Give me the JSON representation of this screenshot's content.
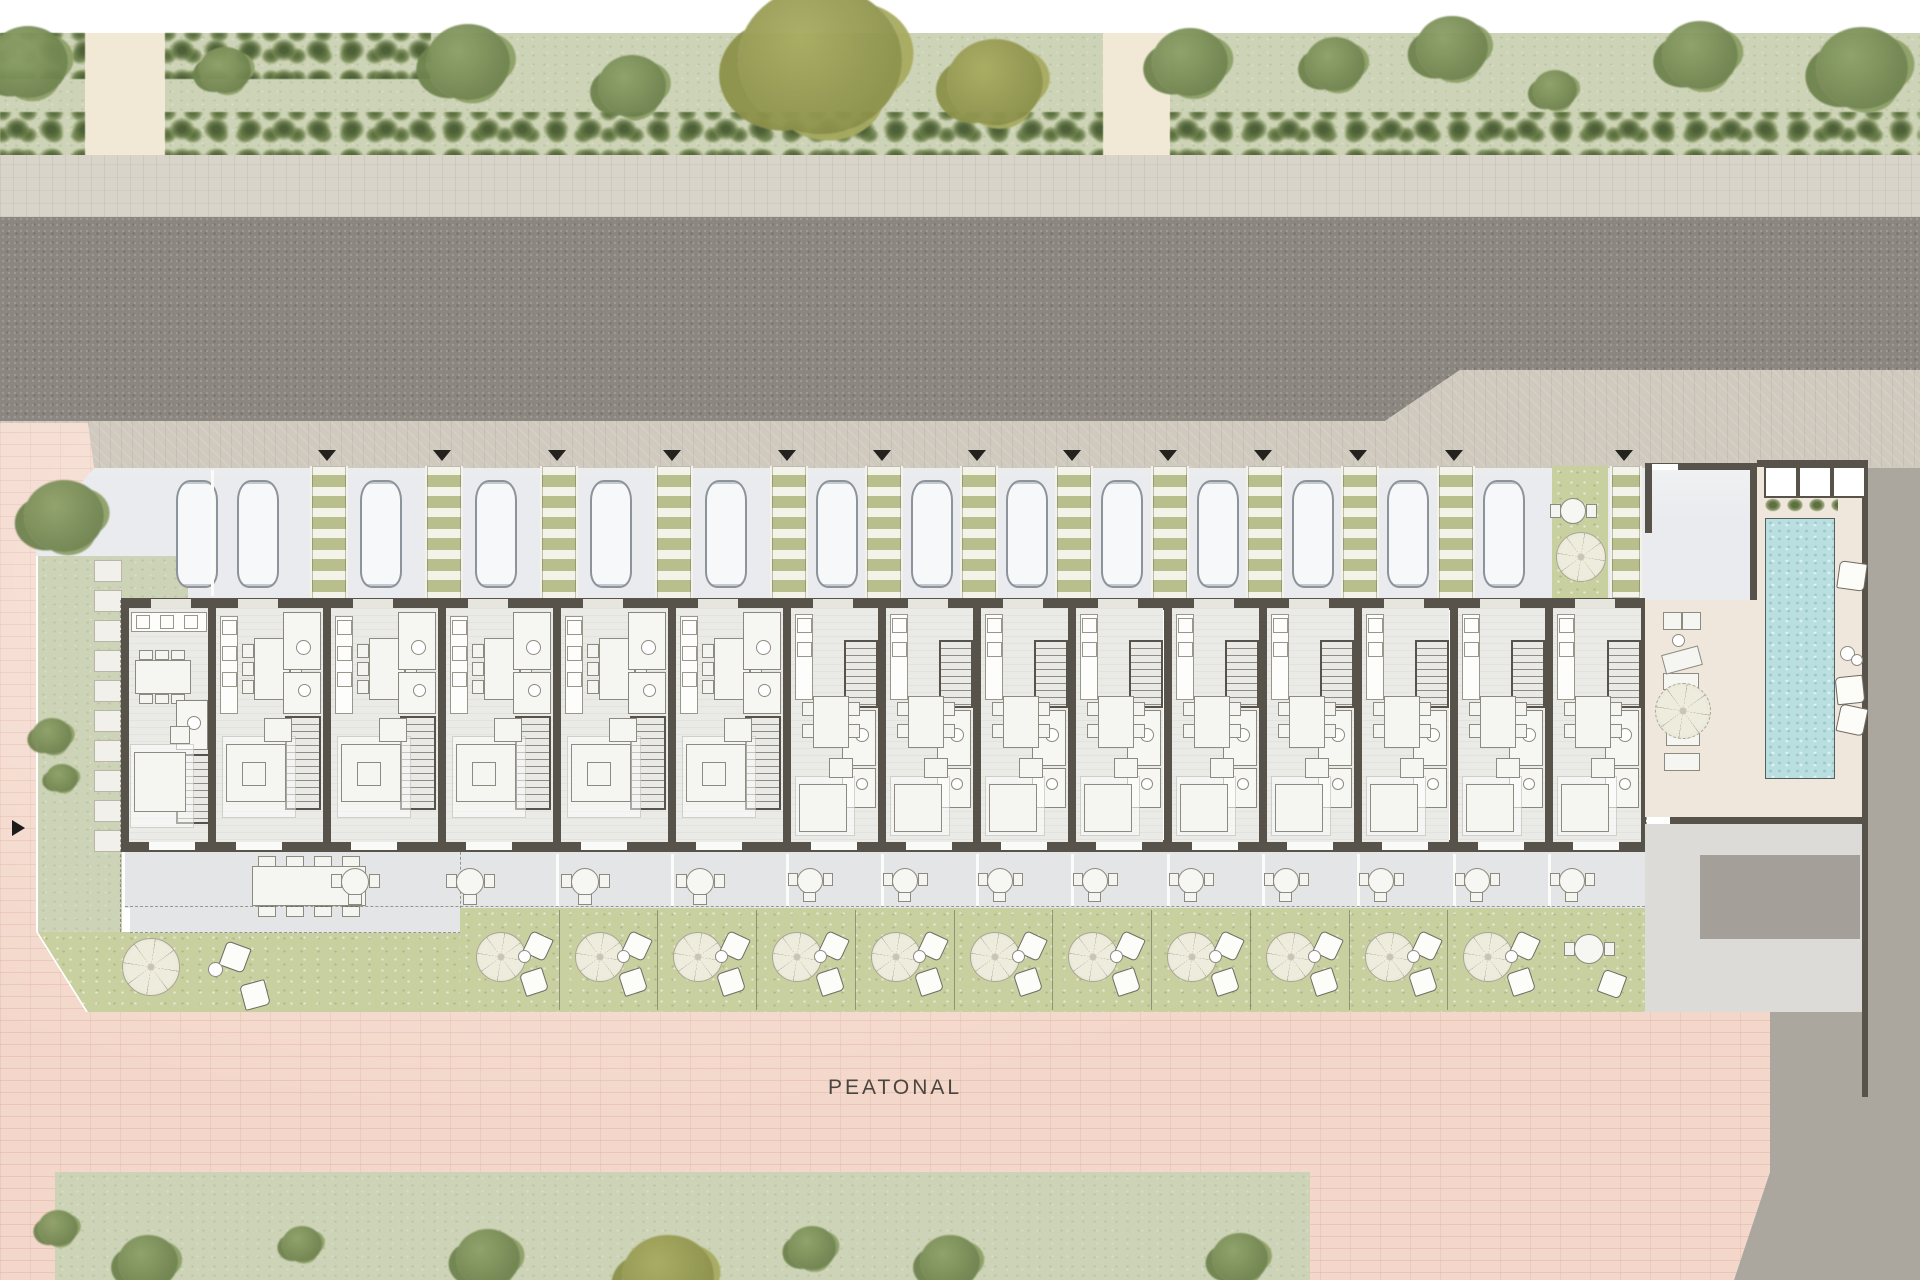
{
  "page": {
    "peatonal_label": "PEATONAL"
  },
  "palette": {
    "white_strip": "#ffffff",
    "lawn": "#cdd3b6",
    "road": "#8b8680",
    "sidewalk": "#d9d4c9",
    "sidewalk2": "#cfc9be",
    "plaza": "#f3d7ca",
    "parking": "#e9ebee",
    "walkway_olive": "#b8be8c",
    "walkway_rung": "#f3f3ea",
    "wall": "#57534a",
    "floor": "#eaeae6",
    "terrace": "#e4e5e7",
    "garden": "#c9d0a0",
    "pool": "#b9dfe0",
    "deck": "#efe7dc",
    "gray_light": "#dcdbd8",
    "gray_out": "#aba69e",
    "gray_mid": "#a49f98",
    "car_fill": "#f7f8fa",
    "car_line": "#8d939b",
    "furn_line": "#8d8a80",
    "furn_fill": "#f5f5f1",
    "text": "#4a463f",
    "beige": "#f1e9d6",
    "tri": "#23221f",
    "tree_green_1": "#8ea168",
    "tree_green_2": "#6f834e",
    "tree_olive_1": "#a8ab60",
    "tree_olive_2": "#8c914a"
  },
  "geo": {
    "white_top": [
      0,
      0,
      1920,
      33
    ],
    "verge_top": [
      0,
      33,
      1920,
      127
    ],
    "sidewalk1": [
      0,
      155,
      1920,
      62
    ],
    "road_poly": [
      [
        0,
        217
      ],
      [
        1920,
        217
      ],
      [
        1920,
        370
      ],
      [
        1460,
        370
      ],
      [
        1385,
        421
      ],
      [
        0,
        421
      ]
    ],
    "walk2_poly": [
      [
        0,
        421
      ],
      [
        1385,
        421
      ],
      [
        1460,
        370
      ],
      [
        1920,
        370
      ],
      [
        1920,
        468
      ],
      [
        0,
        472
      ]
    ],
    "plaza_poly": [
      [
        0,
        423
      ],
      [
        88,
        423
      ],
      [
        94,
        468
      ],
      [
        36,
        538
      ],
      [
        36,
        932
      ],
      [
        86,
        1012
      ],
      [
        1770,
        1012
      ],
      [
        1770,
        1172
      ],
      [
        1734,
        1280
      ],
      [
        0,
        1280
      ]
    ],
    "parking_poly": [
      [
        94,
        468
      ],
      [
        1645,
        468
      ],
      [
        1645,
        600
      ],
      [
        188,
        600
      ],
      [
        188,
        556
      ],
      [
        36,
        556
      ],
      [
        36,
        538
      ]
    ],
    "verge_bottom": [
      55,
      1172,
      1255,
      108
    ],
    "beige_paths": [
      [
        85,
        33,
        80,
        127
      ],
      [
        1103,
        33,
        67,
        127
      ],
      [
        345,
        1186,
        82,
        94
      ]
    ],
    "hedges": [
      [
        0,
        33,
        85,
        46
      ],
      [
        165,
        33,
        266,
        46
      ],
      [
        0,
        112,
        85,
        48
      ],
      [
        165,
        112,
        938,
        48
      ],
      [
        1170,
        112,
        750,
        48
      ],
      [
        60,
        1172,
        285,
        42
      ],
      [
        427,
        1172,
        885,
        42
      ],
      [
        55,
        1172,
        48,
        108
      ]
    ],
    "trees_top": [
      [
        28,
        62,
        40,
        "g"
      ],
      [
        225,
        70,
        26,
        "g"
      ],
      [
        468,
        62,
        42,
        "g"
      ],
      [
        632,
        86,
        34,
        "g"
      ],
      [
        820,
        60,
        82,
        "o"
      ],
      [
        995,
        82,
        48,
        "o"
      ],
      [
        1190,
        62,
        38,
        "g"
      ],
      [
        1335,
        64,
        30,
        "g"
      ],
      [
        1452,
        48,
        36,
        "g"
      ],
      [
        1555,
        90,
        22,
        "g"
      ],
      [
        1700,
        55,
        38,
        "g"
      ],
      [
        1862,
        68,
        46,
        "g"
      ]
    ],
    "trees_bottom": [
      [
        58,
        1228,
        20,
        "g"
      ],
      [
        148,
        1262,
        30,
        "g"
      ],
      [
        302,
        1244,
        20,
        "g"
      ],
      [
        488,
        1258,
        32,
        "g"
      ],
      [
        668,
        1276,
        46,
        "o"
      ],
      [
        812,
        1248,
        24,
        "g"
      ],
      [
        950,
        1262,
        30,
        "g"
      ],
      [
        1240,
        1258,
        28,
        "g"
      ]
    ],
    "trees_site": [
      [
        64,
        516,
        40,
        "g"
      ],
      [
        52,
        736,
        20,
        "g"
      ],
      [
        62,
        778,
        16,
        "g"
      ]
    ],
    "lawn_left": [
      [
        38,
        556,
        150,
        44
      ],
      [
        38,
        600,
        84,
        332
      ]
    ],
    "garden1": {
      "rect": [
        38,
        932,
        422,
        80
      ],
      "clip": [
        [
          0,
          0
        ],
        [
          422,
          0
        ],
        [
          422,
          80
        ],
        [
          50,
          80
        ]
      ]
    },
    "stones": {
      "x": 94,
      "y0": 560,
      "step": 30,
      "count": 10,
      "w": 26,
      "h": 20
    },
    "dash_v": [
      [
        120,
        600,
        332
      ],
      [
        1646,
        602,
        248
      ]
    ],
    "arrow": [
      12,
      820
    ],
    "walkways": [
      327,
      442,
      557,
      672,
      787,
      882,
      977,
      1072,
      1168,
      1263,
      1358,
      1454
    ],
    "walkway_y": 466,
    "walkway_h": 134,
    "walkway_w": 34,
    "extra_walkway": [
      1610,
      466,
      28,
      132
    ],
    "patch": [
      1552,
      466,
      56,
      132
    ],
    "patch_parasol": [
      1580,
      556,
      24
    ],
    "patch_table": [
      1572,
      510,
      12
    ],
    "triangles": [
      327,
      442,
      557,
      672,
      787,
      882,
      977,
      1072,
      1168,
      1263,
      1358,
      1454,
      1624
    ],
    "triangle_y": 450,
    "cars": {
      "xs": [
        176,
        237,
        360,
        475,
        590,
        705,
        816,
        911,
        1006,
        1101,
        1197,
        1292,
        1387,
        1483
      ],
      "y": 480,
      "w": 38,
      "h": 104
    },
    "bay_car": [
      1683,
      486,
      38,
      106
    ],
    "units": {
      "end": {
        "x0": 125,
        "w": 87
      },
      "wide": {
        "x0s": [
          212,
          327,
          442,
          557,
          672
        ],
        "w": 115
      },
      "narrow": {
        "x0s": [
          787,
          882,
          977,
          1072,
          1168,
          1263,
          1358,
          1454,
          1549
        ],
        "w": 95
      }
    },
    "house": {
      "top_wall": [
        121,
        598,
        1528,
        12
      ],
      "bottom_wall": [
        121,
        840,
        1528,
        12
      ],
      "party_xs": [
        212,
        327,
        442,
        557,
        672,
        787,
        882,
        977,
        1072,
        1168,
        1263,
        1358,
        1454,
        1549
      ],
      "end_walls": [
        [
          121,
          598,
          8,
          254
        ],
        [
          1638,
          598,
          8,
          254
        ]
      ],
      "y0": 598,
      "y1": 852
    },
    "terrace": {
      "rect": [
        125,
        852,
        1520,
        56
      ],
      "tables_wide": [
        327,
        442,
        557,
        672
      ],
      "tables_narrow": [
        787,
        882,
        977,
        1072,
        1168,
        1263,
        1358,
        1454,
        1549
      ]
    },
    "unit1_terrace": {
      "rect": [
        130,
        852,
        330,
        80
      ],
      "table": [
        252,
        866,
        112,
        38
      ]
    },
    "gardens": {
      "zone": [
        460,
        908,
        1185,
        104
      ],
      "dividers": [
        559,
        657,
        756,
        855,
        954,
        1052,
        1151,
        1250,
        1349,
        1447,
        1546
      ],
      "starts": [
        460,
        559,
        657,
        756,
        855,
        954,
        1052,
        1151,
        1250,
        1349,
        1447
      ],
      "last": [
        1546,
        908,
        99,
        104
      ]
    },
    "garden1_parasol": [
      150,
      966,
      28
    ],
    "pool_zone": {
      "deck": [
        1645,
        463,
        217,
        354
      ],
      "service": [
        1645,
        824,
        217,
        188
      ],
      "service_dark": [
        1700,
        855,
        160,
        84
      ],
      "walls": [
        [
          1757,
          460,
          111,
          7
        ],
        [
          1862,
          463,
          6,
          634
        ],
        [
          1670,
          817,
          198,
          7
        ]
      ],
      "skylights": [
        [
          1764,
          466,
          30,
          28
        ],
        [
          1798,
          466,
          30,
          28
        ],
        [
          1832,
          466,
          30,
          28
        ]
      ],
      "plants": [
        1762,
        496,
        76,
        20
      ],
      "pool": [
        1765,
        518,
        68,
        259
      ],
      "bay": {
        "rect": [
          1645,
          463,
          112,
          137
        ],
        "walls": [
          [
            1645,
            463,
            112,
            7
          ],
          [
            1645,
            463,
            7,
            70
          ],
          [
            1750,
            463,
            7,
            137
          ]
        ],
        "pane": [
          1652,
          464,
          26,
          6
        ]
      }
    },
    "deck_furniture": {
      "rects": [
        [
          1663,
          612,
          17,
          16
        ],
        [
          1682,
          612,
          17,
          16
        ],
        [
          1663,
          673,
          34,
          15
        ],
        [
          1666,
          730,
          32,
          14
        ],
        [
          1664,
          753,
          34,
          16
        ]
      ],
      "tilted": [
        1663,
        650,
        36,
        18,
        -15
      ],
      "circle": [
        1672,
        634,
        11
      ],
      "parasol": [
        1682,
        710,
        27
      ]
    },
    "pool_pillows": [
      [
        1838,
        562,
        26,
        8
      ],
      [
        1836,
        676,
        26,
        -6
      ],
      [
        1838,
        706,
        26,
        12
      ]
    ],
    "pool_circles": [
      [
        1840,
        646,
        13
      ],
      [
        1851,
        654,
        10
      ]
    ],
    "gray_out_rects": [
      [
        1868,
        468,
        52,
        812
      ],
      [
        1770,
        1012,
        150,
        268
      ]
    ],
    "gray_tri": [
      [
        1770,
        1172
      ],
      [
        1770,
        1280
      ],
      [
        1734,
        1280
      ]
    ],
    "label_pos": [
      828,
      1076
    ]
  }
}
